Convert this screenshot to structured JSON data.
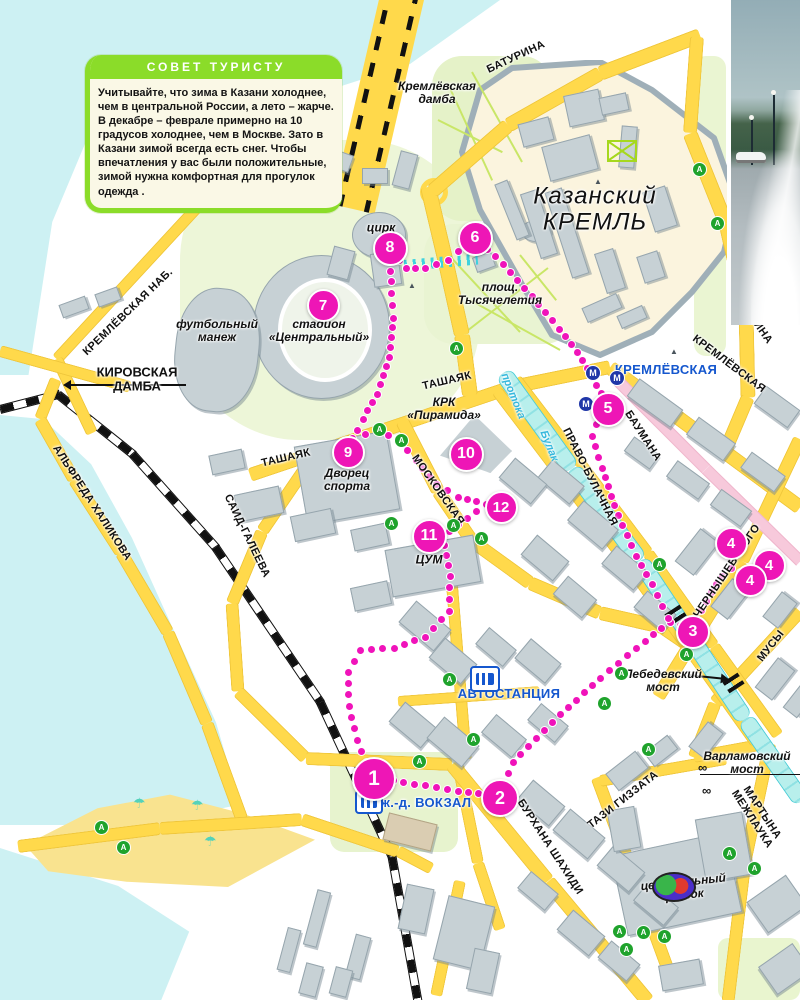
{
  "tip_box": {
    "title": "СОВЕТ ТУРИСТУ",
    "body": "Учитывайте, что зима в Казани холоднее, чем в центральной России, а лето – жарче. В декабре – феврале примерно на 10 градусов холоднее, чем в Москве. Зато в Казани зимой всегда есть снег. Чтобы впечатления у вас были положительные, зимой нужна комфортная для прогулок одежда ."
  },
  "colors": {
    "route": "#F013BA",
    "road": "#FFD94B",
    "water": "#CDF1F3",
    "tip_green": "#8BDC29",
    "label_blue": "#1557CE",
    "pedestrian_pink": "#F7C9DB"
  },
  "labels": [
    {
      "id": "street-baturina-top",
      "text": "БАТУРИНА",
      "x": 516,
      "y": 57,
      "rot": -25,
      "cls": "street"
    },
    {
      "id": "place-kremlevskaya-damba",
      "text": "Кремлёвская\nдамба",
      "x": 437,
      "y": 93,
      "rot": 0,
      "cls": "place"
    },
    {
      "id": "place-kazan-kremlin",
      "text": "Казанский\nКРЕМЛЬ",
      "x": 595,
      "y": 210,
      "rot": 0,
      "cls": "place-xl"
    },
    {
      "id": "street-kremlevskaya-nab",
      "text": "КРЕМЛЁВСКАЯ НАБ.",
      "x": 128,
      "y": 312,
      "rot": -44,
      "cls": "street"
    },
    {
      "id": "street-kirovskaya-damba",
      "text": "КИРОВСКАЯ\nДАМБА",
      "x": 137,
      "y": 380,
      "rot": 0,
      "cls": "street-lg"
    },
    {
      "id": "place-circus",
      "text": "цирк",
      "x": 381,
      "y": 228,
      "rot": 0,
      "cls": "place"
    },
    {
      "id": "place-football-manezh",
      "text": "футбольный\nманеж",
      "x": 217,
      "y": 331,
      "rot": 0,
      "cls": "place"
    },
    {
      "id": "place-stadium",
      "text": "стадион\n«Центральный»",
      "x": 319,
      "y": 331,
      "rot": 0,
      "cls": "place"
    },
    {
      "id": "place-millennium-square",
      "text": "площ.\nТысячелетия",
      "x": 500,
      "y": 294,
      "rot": 0,
      "cls": "place"
    },
    {
      "id": "street-tashayak-east",
      "text": "ТАШАЯК",
      "x": 447,
      "y": 381,
      "rot": -13,
      "cls": "street"
    },
    {
      "id": "street-tashayak-west",
      "text": "ТАШАЯК",
      "x": 286,
      "y": 458,
      "rot": -13,
      "cls": "street"
    },
    {
      "id": "place-pyramid",
      "text": "КРК\n«Пирамида»",
      "x": 444,
      "y": 409,
      "rot": 0,
      "cls": "place"
    },
    {
      "id": "street-moskovskaya",
      "text": "МОСКОВСКАЯ",
      "x": 438,
      "y": 490,
      "rot": 55,
      "cls": "street"
    },
    {
      "id": "place-sports-palace",
      "text": "Дворец\nспорта",
      "x": 347,
      "y": 480,
      "rot": 0,
      "cls": "place"
    },
    {
      "id": "place-tsum",
      "text": "ЦУМ",
      "x": 429,
      "y": 560,
      "rot": 0,
      "cls": "place"
    },
    {
      "id": "canal-protoka",
      "text": "протока",
      "x": 513,
      "y": 396,
      "rot": 68,
      "cls": "cyan-label"
    },
    {
      "id": "canal-bulak",
      "text": "Булак",
      "x": 549,
      "y": 446,
      "rot": 68,
      "cls": "cyan-label"
    },
    {
      "id": "street-pravo-bulachnaya",
      "text": "ПРАВО-БУЛАЧНАЯ",
      "x": 590,
      "y": 477,
      "rot": 63,
      "cls": "street"
    },
    {
      "id": "street-baumana",
      "text": "БАУМАНА",
      "x": 643,
      "y": 436,
      "rot": 57,
      "cls": "street"
    },
    {
      "id": "metro-kremlevskaya-label",
      "text": "КРЕМЛЁВСКАЯ",
      "x": 666,
      "y": 370,
      "rot": 0,
      "cls": "blue-label"
    },
    {
      "id": "street-kremlevskaya",
      "text": "КРЕМЛЁВСКАЯ",
      "x": 729,
      "y": 364,
      "rot": 37,
      "cls": "street"
    },
    {
      "id": "street-baturina-right",
      "text": "БАТУРИНА",
      "x": 752,
      "y": 317,
      "rot": 55,
      "cls": "street"
    },
    {
      "id": "street-said-galeeva",
      "text": "САИД-ГАЛЕЕВА",
      "x": 247,
      "y": 536,
      "rot": 64,
      "cls": "street"
    },
    {
      "id": "street-alfreda-khalikova",
      "text": "АЛЬФРЕДА ХАЛИКОВА",
      "x": 92,
      "y": 503,
      "rot": 57,
      "cls": "street"
    },
    {
      "id": "street-chernyshevskogo",
      "text": "ЧЕРНЫШЕВСКОГО",
      "x": 727,
      "y": 571,
      "rot": -56,
      "cls": "street"
    },
    {
      "id": "street-musy",
      "text": "МУСЫ",
      "x": 771,
      "y": 646,
      "rot": -52,
      "cls": "street"
    },
    {
      "id": "place-lebedevsky-bridge",
      "text": "Лебедевский\nмост",
      "x": 663,
      "y": 681,
      "rot": 0,
      "cls": "place"
    },
    {
      "id": "label-bus-station",
      "text": "АВТОСТАНЦИЯ",
      "x": 509,
      "y": 694,
      "rot": 0,
      "cls": "blue-label"
    },
    {
      "id": "label-rail-terminal",
      "text": "ж.-д. ВОКЗАЛ",
      "x": 426,
      "y": 803,
      "rot": 0,
      "cls": "blue-label"
    },
    {
      "id": "street-burkhana-shakhidi",
      "text": "БУРХАНА ШАХИДИ",
      "x": 550,
      "y": 847,
      "rot": 57,
      "cls": "street"
    },
    {
      "id": "street-tazi-gizzata",
      "text": "ТАЗИ ГИЗЗАТА",
      "x": 623,
      "y": 800,
      "rot": -38,
      "cls": "street"
    },
    {
      "id": "place-varlamovsky-bridge",
      "text": "Варламовский\nмост",
      "x": 747,
      "y": 763,
      "rot": 0,
      "cls": "place"
    },
    {
      "id": "street-martyna-mezhlauka",
      "text": "МАРТЫНА\nМЕЖЛАУКА",
      "x": 757,
      "y": 816,
      "rot": 57,
      "cls": "street"
    },
    {
      "id": "place-central-market",
      "text": "центральный\nрынок",
      "x": 684,
      "y": 889,
      "rot": -6,
      "cls": "place"
    }
  ],
  "waypoints": [
    {
      "n": "1",
      "x": 372,
      "y": 777,
      "s": 40
    },
    {
      "n": "2",
      "x": 498,
      "y": 796,
      "s": 34
    },
    {
      "n": "3",
      "x": 691,
      "y": 630,
      "s": 30
    },
    {
      "n": "4",
      "x": 729,
      "y": 541,
      "s": 29
    },
    {
      "n": "4",
      "x": 767,
      "y": 563,
      "s": 29
    },
    {
      "n": "4",
      "x": 748,
      "y": 578,
      "s": 29
    },
    {
      "n": "5",
      "x": 606,
      "y": 407,
      "s": 31
    },
    {
      "n": "6",
      "x": 473,
      "y": 236,
      "s": 31
    },
    {
      "n": "7",
      "x": 321,
      "y": 303,
      "s": 29
    },
    {
      "n": "8",
      "x": 388,
      "y": 246,
      "s": 31
    },
    {
      "n": "9",
      "x": 346,
      "y": 450,
      "s": 29
    },
    {
      "n": "10",
      "x": 464,
      "y": 452,
      "s": 31
    },
    {
      "n": "11",
      "x": 427,
      "y": 534,
      "s": 31
    },
    {
      "n": "12",
      "x": 499,
      "y": 505,
      "s": 29
    }
  ],
  "route_legs": [
    [
      [
        372,
        777
      ],
      [
        414,
        784
      ],
      [
        458,
        791
      ],
      [
        498,
        796
      ]
    ],
    [
      [
        498,
        796
      ],
      [
        513,
        762
      ],
      [
        552,
        722
      ],
      [
        600,
        678
      ],
      [
        645,
        641
      ],
      [
        670,
        622
      ],
      [
        691,
        629
      ]
    ],
    [
      [
        691,
        629
      ],
      [
        706,
        601
      ],
      [
        722,
        576
      ],
      [
        731,
        568
      ],
      [
        749,
        577
      ]
    ],
    [
      [
        731,
        568
      ],
      [
        729,
        547
      ]
    ],
    [
      [
        668,
        618
      ],
      [
        652,
        584
      ],
      [
        636,
        556
      ],
      [
        618,
        515
      ],
      [
        602,
        468
      ],
      [
        592,
        436
      ],
      [
        601,
        413
      ]
    ],
    [
      [
        606,
        402
      ],
      [
        592,
        377
      ],
      [
        577,
        352
      ],
      [
        559,
        329
      ],
      [
        532,
        296
      ],
      [
        503,
        264
      ],
      [
        480,
        242
      ]
    ],
    [
      [
        468,
        243
      ],
      [
        448,
        260
      ],
      [
        425,
        268
      ],
      [
        406,
        268
      ],
      [
        392,
        252
      ]
    ],
    [
      [
        388,
        252
      ],
      [
        391,
        281
      ],
      [
        393,
        318
      ],
      [
        389,
        357
      ],
      [
        377,
        394
      ],
      [
        363,
        419
      ],
      [
        351,
        441
      ]
    ],
    [
      [
        352,
        438
      ],
      [
        378,
        430
      ],
      [
        398,
        440
      ],
      [
        416,
        460
      ],
      [
        436,
        484
      ],
      [
        458,
        497
      ],
      [
        486,
        504
      ]
    ],
    [
      [
        486,
        504
      ],
      [
        467,
        518
      ],
      [
        449,
        531
      ]
    ],
    [
      [
        444,
        545
      ],
      [
        450,
        576
      ],
      [
        449,
        611
      ],
      [
        425,
        637
      ],
      [
        394,
        648
      ],
      [
        360,
        650
      ],
      [
        348,
        672
      ],
      [
        349,
        706
      ],
      [
        357,
        740
      ],
      [
        366,
        762
      ]
    ]
  ],
  "bus_stops": {
    "glyph": "А",
    "positions": [
      [
        698,
        168
      ],
      [
        716,
        222
      ],
      [
        455,
        347
      ],
      [
        378,
        428
      ],
      [
        400,
        439
      ],
      [
        390,
        522
      ],
      [
        452,
        524
      ],
      [
        480,
        537
      ],
      [
        658,
        563
      ],
      [
        685,
        653
      ],
      [
        620,
        672
      ],
      [
        603,
        702
      ],
      [
        647,
        748
      ],
      [
        418,
        760
      ],
      [
        448,
        678
      ],
      [
        472,
        738
      ],
      [
        728,
        852
      ],
      [
        753,
        867
      ],
      [
        618,
        930
      ],
      [
        642,
        931
      ],
      [
        663,
        935
      ],
      [
        625,
        948
      ],
      [
        100,
        826
      ],
      [
        122,
        846
      ]
    ]
  },
  "metro": {
    "glyph": "М",
    "positions": [
      [
        592,
        372
      ],
      [
        616,
        377
      ],
      [
        585,
        403
      ]
    ]
  },
  "towers": [
    [
      598,
      182
    ],
    [
      674,
      352
    ],
    [
      412,
      286
    ]
  ],
  "sights": [
    [
      704,
      768
    ],
    [
      708,
      791
    ]
  ],
  "umbrellas": [
    [
      140,
      805
    ],
    [
      198,
      807
    ],
    [
      211,
      843
    ]
  ]
}
